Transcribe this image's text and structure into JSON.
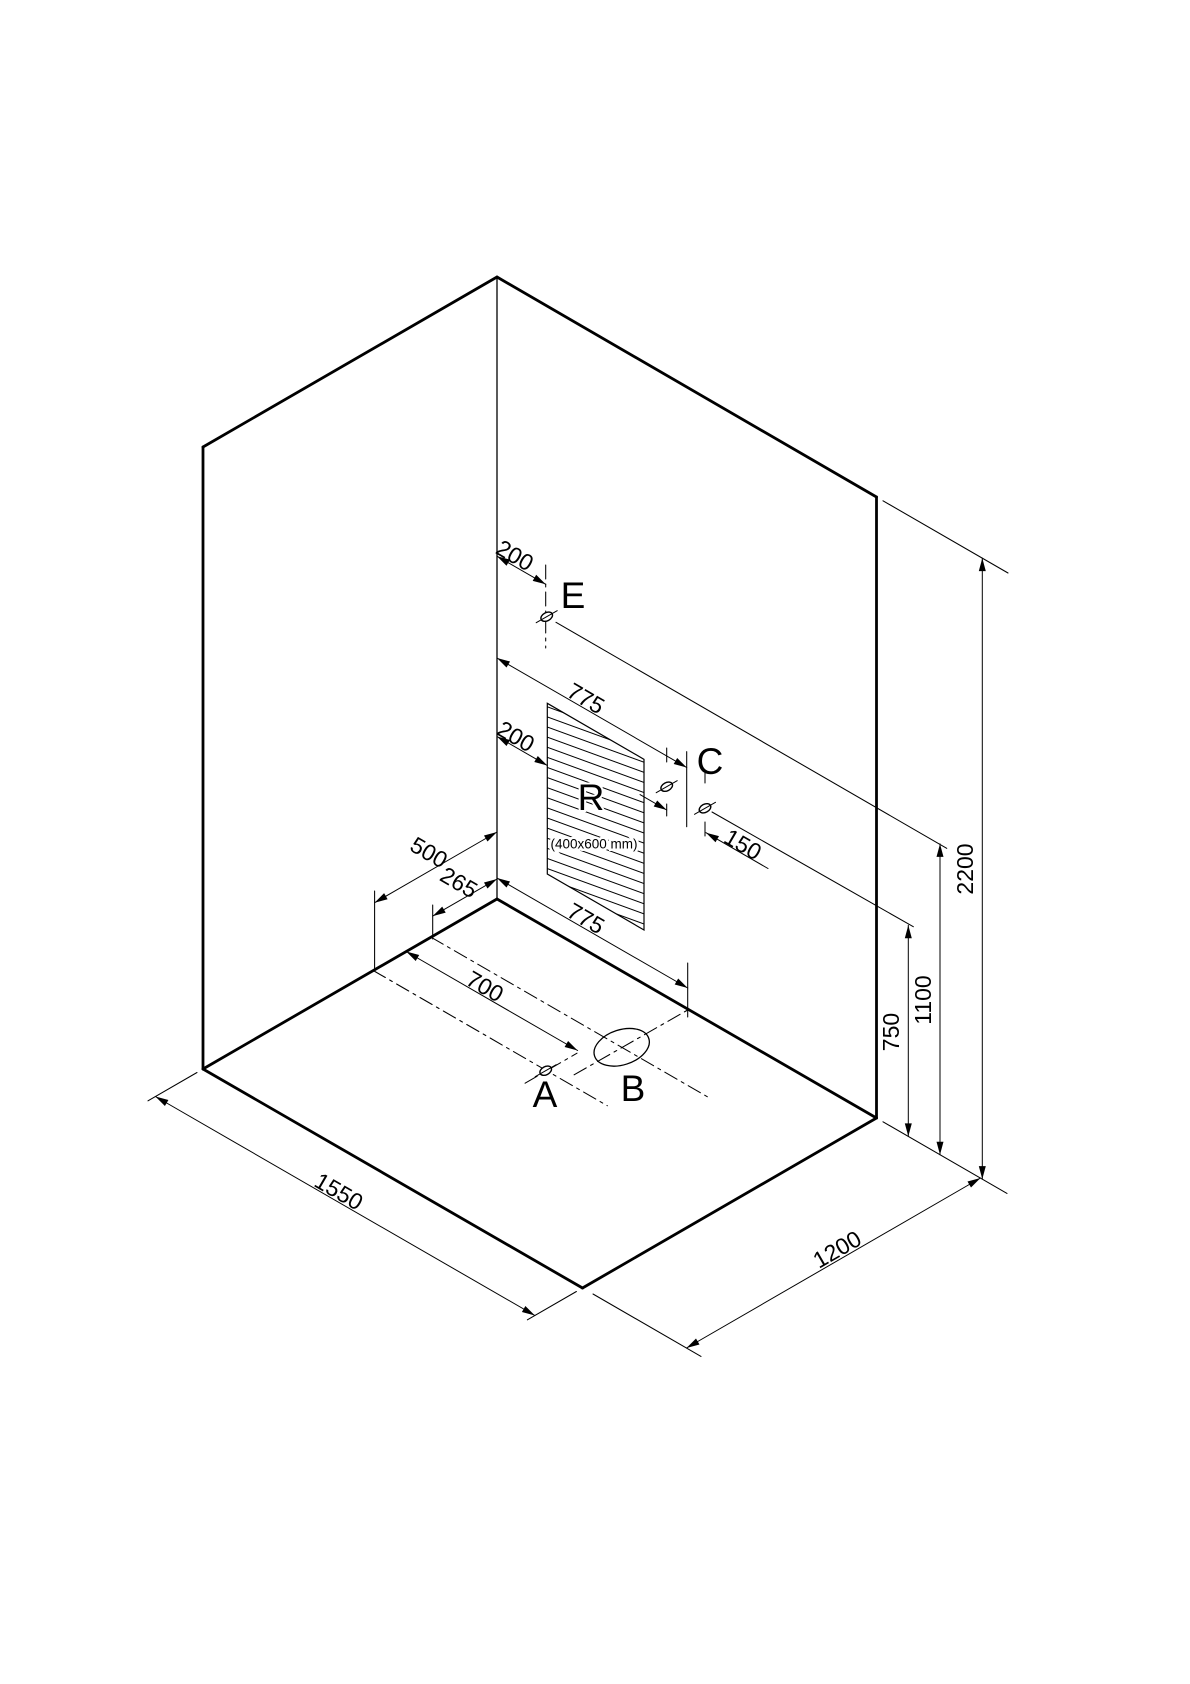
{
  "title": "Isometric installation drawing - room corner with connection points",
  "colors": {
    "ink": "#000000",
    "paper": "#ffffff"
  },
  "room": {
    "width_label": "1550",
    "depth_label": "1200",
    "height_label": "2200"
  },
  "panel": {
    "letter": "R",
    "size_label": "(400x600 mm)"
  },
  "point_letters": [
    "A",
    "B",
    "C",
    "E"
  ],
  "measurement_values": [
    "200",
    "775",
    "200",
    "150",
    "500",
    "265",
    "700",
    "775",
    "1550",
    "1200",
    "750",
    "1100",
    "2200"
  ],
  "drawing": {
    "canvas": {
      "w": 1190,
      "h": 1684
    },
    "thick_lines": [
      {
        "name": "wall-left-top-edge",
        "x1": 203,
        "y1": 447,
        "x2": 497,
        "y2": 277
      },
      {
        "name": "wall-right-top-edge",
        "x1": 497,
        "y1": 277,
        "x2": 876.5,
        "y2": 497
      },
      {
        "name": "wall-left-outer-edge",
        "x1": 203,
        "y1": 447,
        "x2": 203,
        "y2": 1069
      },
      {
        "name": "wall-right-outer-edge",
        "x1": 876.5,
        "y1": 497,
        "x2": 876.5,
        "y2": 1118
      },
      {
        "name": "floor-back-left-edge",
        "x1": 497,
        "y1": 899,
        "x2": 203,
        "y2": 1069
      },
      {
        "name": "floor-back-right-edge",
        "x1": 497,
        "y1": 899,
        "x2": 876.5,
        "y2": 1118
      },
      {
        "name": "floor-front-left-edge",
        "x1": 203,
        "y1": 1069,
        "x2": 582.5,
        "y2": 1288
      },
      {
        "name": "floor-front-right-edge",
        "x1": 876.5,
        "y1": 1118,
        "x2": 582.5,
        "y2": 1288
      }
    ],
    "corner_line": {
      "name": "wall-corner-edge",
      "x1": 497,
      "y1": 277,
      "x2": 497,
      "y2": 899
    },
    "panel_polygon": {
      "name": "panel-r-hatched",
      "points": "547.3,703.3 644,759.3 644,930 547.3,874"
    },
    "ext_lines": [
      {
        "name": "ext-e-height",
        "x1": 556,
        "y1": 622.3,
        "x2": 946.7,
        "y2": 848.3
      },
      {
        "name": "ext-c-height",
        "x1": 712,
        "y1": 812,
        "x2": 913.3,
        "y2": 926.7
      },
      {
        "name": "ext-top-right",
        "x1": 883,
        "y1": 500.8,
        "x2": 1008,
        "y2": 573
      },
      {
        "name": "ext-floor-right",
        "x1": 883,
        "y1": 1121.8,
        "x2": 1007,
        "y2": 1193.4
      },
      {
        "name": "ext-c-mid-upper",
        "x1": 686.7,
        "y1": 751.7,
        "x2": 686.7,
        "y2": 826.7
      },
      {
        "name": "ext-c-mid-lower",
        "x1": 687.7,
        "y1": 963,
        "x2": 687.7,
        "y2": 1017
      },
      {
        "name": "ext-265",
        "x1": 432.7,
        "y1": 905,
        "x2": 432.7,
        "y2": 939
      },
      {
        "name": "ext-500",
        "x1": 374.6,
        "y1": 891,
        "x2": 374.6,
        "y2": 971
      },
      {
        "name": "ext-1550-left",
        "x1": 197,
        "y1": 1072.5,
        "x2": 148,
        "y2": 1100.8
      },
      {
        "name": "ext-1550-right",
        "x1": 576.4,
        "y1": 1291.5,
        "x2": 527.4,
        "y2": 1319.8
      },
      {
        "name": "ext-1200-left",
        "x1": 593,
        "y1": 1294,
        "x2": 701,
        "y2": 1356.4
      },
      {
        "name": "tick-c1-upper",
        "x1": 666.7,
        "y1": 748,
        "x2": 666.7,
        "y2": 762
      },
      {
        "name": "tick-c1-lower",
        "x1": 666.7,
        "y1": 804,
        "x2": 666.7,
        "y2": 816
      },
      {
        "name": "tick-c2-upper",
        "x1": 705,
        "y1": 770,
        "x2": 705,
        "y2": 783
      },
      {
        "name": "tick-c2-lower",
        "x1": 705,
        "y1": 822,
        "x2": 705,
        "y2": 836
      }
    ],
    "centerlines": [
      {
        "name": "centerline-b-long",
        "x1": 431,
        "y1": 937.2,
        "x2": 708.3,
        "y2": 1097.3
      },
      {
        "name": "centerline-a-long",
        "x1": 373.2,
        "y1": 970.5,
        "x2": 607.3,
        "y2": 1105.7
      },
      {
        "name": "centerline-b-perp",
        "x1": 574.1,
        "y1": 1074.8,
        "x2": 687.7,
        "y2": 1010
      },
      {
        "name": "centerline-a-perp",
        "x1": 525.1,
        "y1": 1083.2,
        "x2": 577,
        "y2": 1053.2
      },
      {
        "name": "centerline-e-vertical",
        "x1": 545.7,
        "y1": 565,
        "x2": 545.7,
        "y2": 648
      }
    ],
    "dimensions": [
      {
        "name": "dim-200-e",
        "label": "200",
        "x1": 497,
        "y1": 556.2,
        "x2": 545.7,
        "y2": 584.3,
        "lx": 514,
        "ly": 557,
        "rot": 30
      },
      {
        "name": "dim-775-upper",
        "label": "775",
        "x1": 497,
        "y1": 658,
        "x2": 686.7,
        "y2": 767.5,
        "lx": 585,
        "ly": 700,
        "rot": 30
      },
      {
        "name": "dim-200-r",
        "label": "200",
        "x1": 497,
        "y1": 736.5,
        "x2": 547.3,
        "y2": 765.5,
        "lx": 515,
        "ly": 738,
        "rot": 30
      },
      {
        "name": "dim-500",
        "label": "500",
        "x1": 374.6,
        "y1": 902.7,
        "x2": 497,
        "y2": 832,
        "lx": 428,
        "ly": 854,
        "rot": 30
      },
      {
        "name": "dim-265",
        "label": "265",
        "x1": 432.7,
        "y1": 916.1,
        "x2": 497,
        "y2": 879,
        "lx": 458,
        "ly": 884,
        "rot": 30
      },
      {
        "name": "dim-700",
        "label": "700",
        "x1": 406.2,
        "y1": 951.5,
        "x2": 577.6,
        "y2": 1050.5,
        "lx": 484,
        "ly": 988,
        "rot": 30
      },
      {
        "name": "dim-775-lower",
        "label": "775",
        "x1": 497,
        "y1": 878,
        "x2": 687.7,
        "y2": 988,
        "lx": 585,
        "ly": 920,
        "rot": 30
      },
      {
        "name": "dim-1550",
        "label": "1550",
        "x1": 155.4,
        "y1": 1096.5,
        "x2": 534.9,
        "y2": 1315.5,
        "lx": 338,
        "ly": 1193,
        "rot": 30
      },
      {
        "name": "dim-1200",
        "label": "1200",
        "x1": 686.5,
        "y1": 1348,
        "x2": 980.5,
        "y2": 1178,
        "lx": 838,
        "ly": 1251,
        "rot": -30
      },
      {
        "name": "dim-750",
        "label": "750",
        "x1": 908.3,
        "y1": 1136.4,
        "x2": 908.3,
        "y2": 925.3,
        "lx": 893,
        "ly": 1032,
        "rot": -90
      },
      {
        "name": "dim-1100",
        "label": "1100",
        "x1": 940,
        "y1": 1154.7,
        "x2": 940,
        "y2": 843.9,
        "lx": 925,
        "ly": 1000,
        "rot": -90
      },
      {
        "name": "dim-2200",
        "label": "2200",
        "x1": 982.3,
        "y1": 1179.1,
        "x2": 982.3,
        "y2": 558.1,
        "lx": 967,
        "ly": 869,
        "rot": -90
      }
    ],
    "outside_dimensions": [
      {
        "name": "dim-150",
        "label": "150",
        "lx": 742,
        "ly": 846,
        "rot": 30,
        "segs": [
          {
            "x1": 640,
            "y1": 794.6,
            "x2": 666.7,
            "y2": 810
          },
          {
            "x1": 768,
            "y1": 868.5,
            "x2": 706,
            "y2": 832.7
          }
        ]
      }
    ],
    "fittings": [
      {
        "id": "E",
        "name": "connection-point-e",
        "cx": 546.7,
        "cy": 616.7,
        "kind": "small"
      },
      {
        "id": "C1",
        "name": "connection-point-c1",
        "cx": 666.7,
        "cy": 786.7,
        "kind": "small"
      },
      {
        "id": "C2",
        "name": "connection-point-c2",
        "cx": 705,
        "cy": 808.3,
        "kind": "small"
      },
      {
        "id": "A",
        "name": "connection-point-a",
        "cx": 545.7,
        "cy": 1070.7,
        "kind": "small"
      },
      {
        "id": "B",
        "name": "drain-point-b",
        "cx": 621.7,
        "cy": 1047.3,
        "kind": "large"
      }
    ],
    "labels": [
      {
        "name": "label-e",
        "text": "E",
        "x": 573,
        "y": 598,
        "cls": "t-letter"
      },
      {
        "name": "label-c",
        "text": "C",
        "x": 710,
        "y": 764,
        "cls": "t-letter"
      },
      {
        "name": "label-r",
        "text": "R",
        "x": 591,
        "y": 800,
        "cls": "t-letter t-halo"
      },
      {
        "name": "label-r-size",
        "text": "(400x600 mm)",
        "x": 594,
        "y": 845,
        "cls": "t-small"
      },
      {
        "name": "label-a",
        "text": "A",
        "x": 545,
        "y": 1097,
        "cls": "t-letter"
      },
      {
        "name": "label-b",
        "text": "B",
        "x": 633,
        "y": 1091,
        "cls": "t-letter"
      }
    ]
  }
}
